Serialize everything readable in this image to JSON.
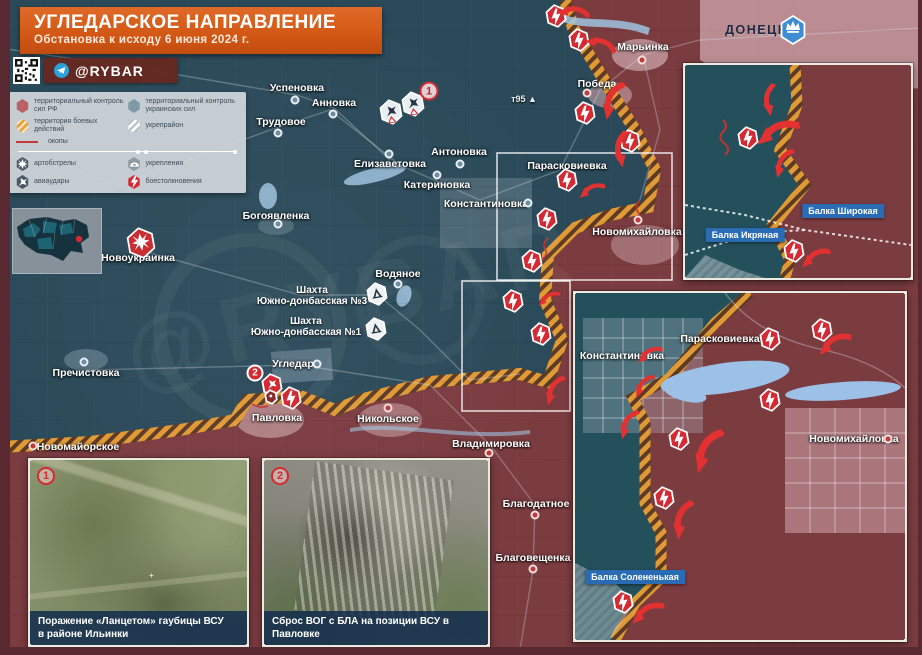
{
  "title": {
    "heading": "УГЛЕДАРСКОЕ НАПРАВЛЕНИЕ",
    "subheading": "Обстановка к исходу 6 июня 2024 г."
  },
  "branding": {
    "channel": "@RYBAR"
  },
  "legend": {
    "items": [
      {
        "id": "ru-control",
        "label": "территориальный контроль сил РФ"
      },
      {
        "id": "ua-control",
        "label": "территориальный контроль украинских сил"
      },
      {
        "id": "combat-zone",
        "label": "территория боевых действий"
      },
      {
        "id": "fortified-area",
        "label": "укрепрайон"
      },
      {
        "id": "trenches",
        "label": "окопы"
      },
      {
        "id": "artillery",
        "label": "артобстрелы"
      },
      {
        "id": "fortifications",
        "label": "укрепления"
      },
      {
        "id": "airstrikes",
        "label": "авиаудары"
      },
      {
        "id": "clashes",
        "label": "боестолкновения"
      }
    ]
  },
  "map": {
    "donetsk_label": "ДОНЕЦК",
    "elevation_point": "т95 ▲",
    "settlements_main": [
      {
        "name": "Успеновка",
        "x": 297,
        "y": 88,
        "dot": {
          "dx": -2,
          "dy": 12,
          "t": "ua"
        }
      },
      {
        "name": "Анновка",
        "x": 334,
        "y": 103,
        "dot": {
          "dx": -1,
          "dy": 11,
          "t": "ua"
        }
      },
      {
        "name": "Трудовое",
        "x": 281,
        "y": 122,
        "dot": {
          "dx": -3,
          "dy": 11,
          "t": "ua"
        }
      },
      {
        "name": "Елизаветовка",
        "x": 390,
        "y": 164,
        "dot": {
          "dx": -1,
          "dy": -10,
          "t": "ua"
        }
      },
      {
        "name": "Антоновка",
        "x": 459,
        "y": 152,
        "dot": {
          "dx": 1,
          "dy": 12,
          "t": "ua"
        }
      },
      {
        "name": "Катериновка",
        "x": 437,
        "y": 185,
        "dot": {
          "dx": 0,
          "dy": -10,
          "t": "ua"
        }
      },
      {
        "name": "Константиновка",
        "x": 486,
        "y": 204,
        "dot": {
          "dx": 42,
          "dy": -1,
          "t": "ua"
        }
      },
      {
        "name": "Парасковиевка",
        "x": 567,
        "y": 166,
        "dot": null
      },
      {
        "name": "Новомихайловка",
        "x": 637,
        "y": 232,
        "dot": {
          "dx": 1,
          "dy": -12,
          "t": "ru"
        }
      },
      {
        "name": "Марьинка",
        "x": 643,
        "y": 47,
        "dot": {
          "dx": -1,
          "dy": 13,
          "t": "ru"
        }
      },
      {
        "name": "Победа",
        "x": 597,
        "y": 84,
        "dot": {
          "dx": -10,
          "dy": 9,
          "t": "ru"
        }
      },
      {
        "name": "Новоукраинка",
        "x": 138,
        "y": 258,
        "dot": null
      },
      {
        "name": "Богоявленка",
        "x": 276,
        "y": 216,
        "dot": {
          "dx": 2,
          "dy": 8,
          "t": "ua"
        }
      },
      {
        "name": "Водяное",
        "x": 398,
        "y": 274,
        "dot": {
          "dx": 0,
          "dy": 10,
          "t": "ua"
        }
      },
      {
        "name": "Пречистовка",
        "x": 86,
        "y": 373,
        "dot": {
          "dx": -2,
          "dy": -11,
          "t": "ua"
        }
      },
      {
        "name": "Угледар",
        "x": 293,
        "y": 364,
        "dot": {
          "dx": 24,
          "dy": 0,
          "t": "ua"
        }
      },
      {
        "name": "Павловка",
        "x": 277,
        "y": 418,
        "dot": null
      },
      {
        "name": "Никольское",
        "x": 388,
        "y": 419,
        "dot": {
          "dx": 0,
          "dy": -11,
          "t": "ru"
        }
      },
      {
        "name": "Новомайорское",
        "x": 78,
        "y": 447,
        "dot": {
          "dx": -45,
          "dy": -1,
          "t": "ru"
        }
      },
      {
        "name": "Владимировка",
        "x": 491,
        "y": 444,
        "dot": {
          "dx": -2,
          "dy": 9,
          "t": "ru"
        }
      },
      {
        "name": "Благодатное",
        "x": 536,
        "y": 504,
        "dot": {
          "dx": -1,
          "dy": 11,
          "t": "ru"
        }
      },
      {
        "name": "Благовещенка",
        "x": 533,
        "y": 558,
        "dot": {
          "dx": 0,
          "dy": 11,
          "t": "ru"
        }
      }
    ],
    "settlements_inset2": [
      {
        "name": "Константиновка",
        "x": 47,
        "y": 63,
        "dot": null
      },
      {
        "name": "Парасковиевка",
        "x": 145,
        "y": 46,
        "dot": null
      },
      {
        "name": "Новомихайловка",
        "x": 279,
        "y": 146,
        "dot": {
          "dx": 34,
          "dy": 0,
          "t": "ru"
        }
      }
    ],
    "mines": [
      {
        "name": "Шахта\nЮжно-донбасская №3",
        "x": 312,
        "y": 296,
        "ix": 377,
        "iy": 294
      },
      {
        "name": "Шахта\nЮжно-донбасская №1",
        "x": 306,
        "y": 327,
        "ix": 376,
        "iy": 329
      }
    ],
    "balka_tags_inset1": [
      {
        "label": "Балка Широкая",
        "x": 158,
        "y": 146
      },
      {
        "label": "Балка Икряная",
        "x": 60,
        "y": 170
      }
    ],
    "balka_tags_inset2": [
      {
        "label": "Балка Солененькая",
        "x": 60,
        "y": 284
      }
    ],
    "clash_main": [
      {
        "x": 556,
        "y": 16
      },
      {
        "x": 579,
        "y": 40
      },
      {
        "x": 585,
        "y": 113
      },
      {
        "x": 630,
        "y": 141
      },
      {
        "x": 567,
        "y": 180
      },
      {
        "x": 547,
        "y": 219
      },
      {
        "x": 532,
        "y": 261
      },
      {
        "x": 513,
        "y": 301
      },
      {
        "x": 541,
        "y": 334
      },
      {
        "x": 291,
        "y": 398
      }
    ],
    "clash_inset1": [
      {
        "x": 63,
        "y": 73
      },
      {
        "x": 109,
        "y": 186
      }
    ],
    "clash_inset2": [
      {
        "x": 195,
        "y": 46
      },
      {
        "x": 247,
        "y": 37
      },
      {
        "x": 195,
        "y": 107
      },
      {
        "x": 104,
        "y": 146
      },
      {
        "x": 89,
        "y": 205
      },
      {
        "x": 48,
        "y": 309
      }
    ],
    "airstrike_icons": [
      {
        "x": 391,
        "y": 112
      },
      {
        "x": 413,
        "y": 104
      }
    ],
    "shelling_icon": {
      "x": 141,
      "y": 243
    },
    "drone_icon": {
      "x": 272,
      "y": 385
    },
    "smallhex_icon": {
      "x": 271,
      "y": 397
    },
    "badges": [
      {
        "text": "1",
        "x": 429,
        "y": 91,
        "style": "outline"
      },
      {
        "text": "2",
        "x": 255,
        "y": 373,
        "style": "solid"
      }
    ],
    "arrows_main": [
      {
        "x": 573,
        "y": 14,
        "r": 20,
        "s": 0.8
      },
      {
        "x": 600,
        "y": 46,
        "r": 35,
        "s": 0.8
      },
      {
        "x": 615,
        "y": 102,
        "r": -50,
        "s": 1
      },
      {
        "x": 624,
        "y": 150,
        "r": -70,
        "s": 0.9
      },
      {
        "x": 592,
        "y": 192,
        "r": -10,
        "s": 0.7
      },
      {
        "x": 549,
        "y": 300,
        "r": -15,
        "s": 0.6
      },
      {
        "x": 556,
        "y": 391,
        "r": -45,
        "s": 0.8
      }
    ],
    "arrows_inset1": [
      {
        "x": 87,
        "y": 35,
        "r": -70,
        "s": 0.8
      },
      {
        "x": 93,
        "y": 70,
        "r": -10,
        "s": 1.15
      },
      {
        "x": 100,
        "y": 99,
        "r": -45,
        "s": 0.8
      },
      {
        "x": 131,
        "y": 194,
        "r": -15,
        "s": 0.8
      }
    ],
    "arrows_inset2": [
      {
        "x": 75,
        "y": 63,
        "r": -15,
        "s": 0.7
      },
      {
        "x": 260,
        "y": 53,
        "r": -15,
        "s": 0.9
      },
      {
        "x": 70,
        "y": 94,
        "r": -35,
        "s": 0.7
      },
      {
        "x": 55,
        "y": 132,
        "r": -45,
        "s": 0.8
      },
      {
        "x": 135,
        "y": 160,
        "r": -45,
        "s": 1.2
      },
      {
        "x": 110,
        "y": 228,
        "r": -55,
        "s": 1
      },
      {
        "x": 73,
        "y": 322,
        "r": -15,
        "s": 0.9
      }
    ]
  },
  "photos": [
    {
      "number": "1",
      "caption": "Поражение «Ланцетом» гаубицы ВСУ\nв районе Ильинки"
    },
    {
      "number": "2",
      "caption": "Сброс ВОГ с БЛА на позиции ВСУ в Павловке"
    }
  ],
  "colors": {
    "ru_territory": "#7b3c40",
    "ua_territory": "#2b4a59",
    "combat_hatch": "#e09a35",
    "clash_red": "#d42a33",
    "tag_blue": "#2a6cb4",
    "banner_orange": "#d25714"
  }
}
